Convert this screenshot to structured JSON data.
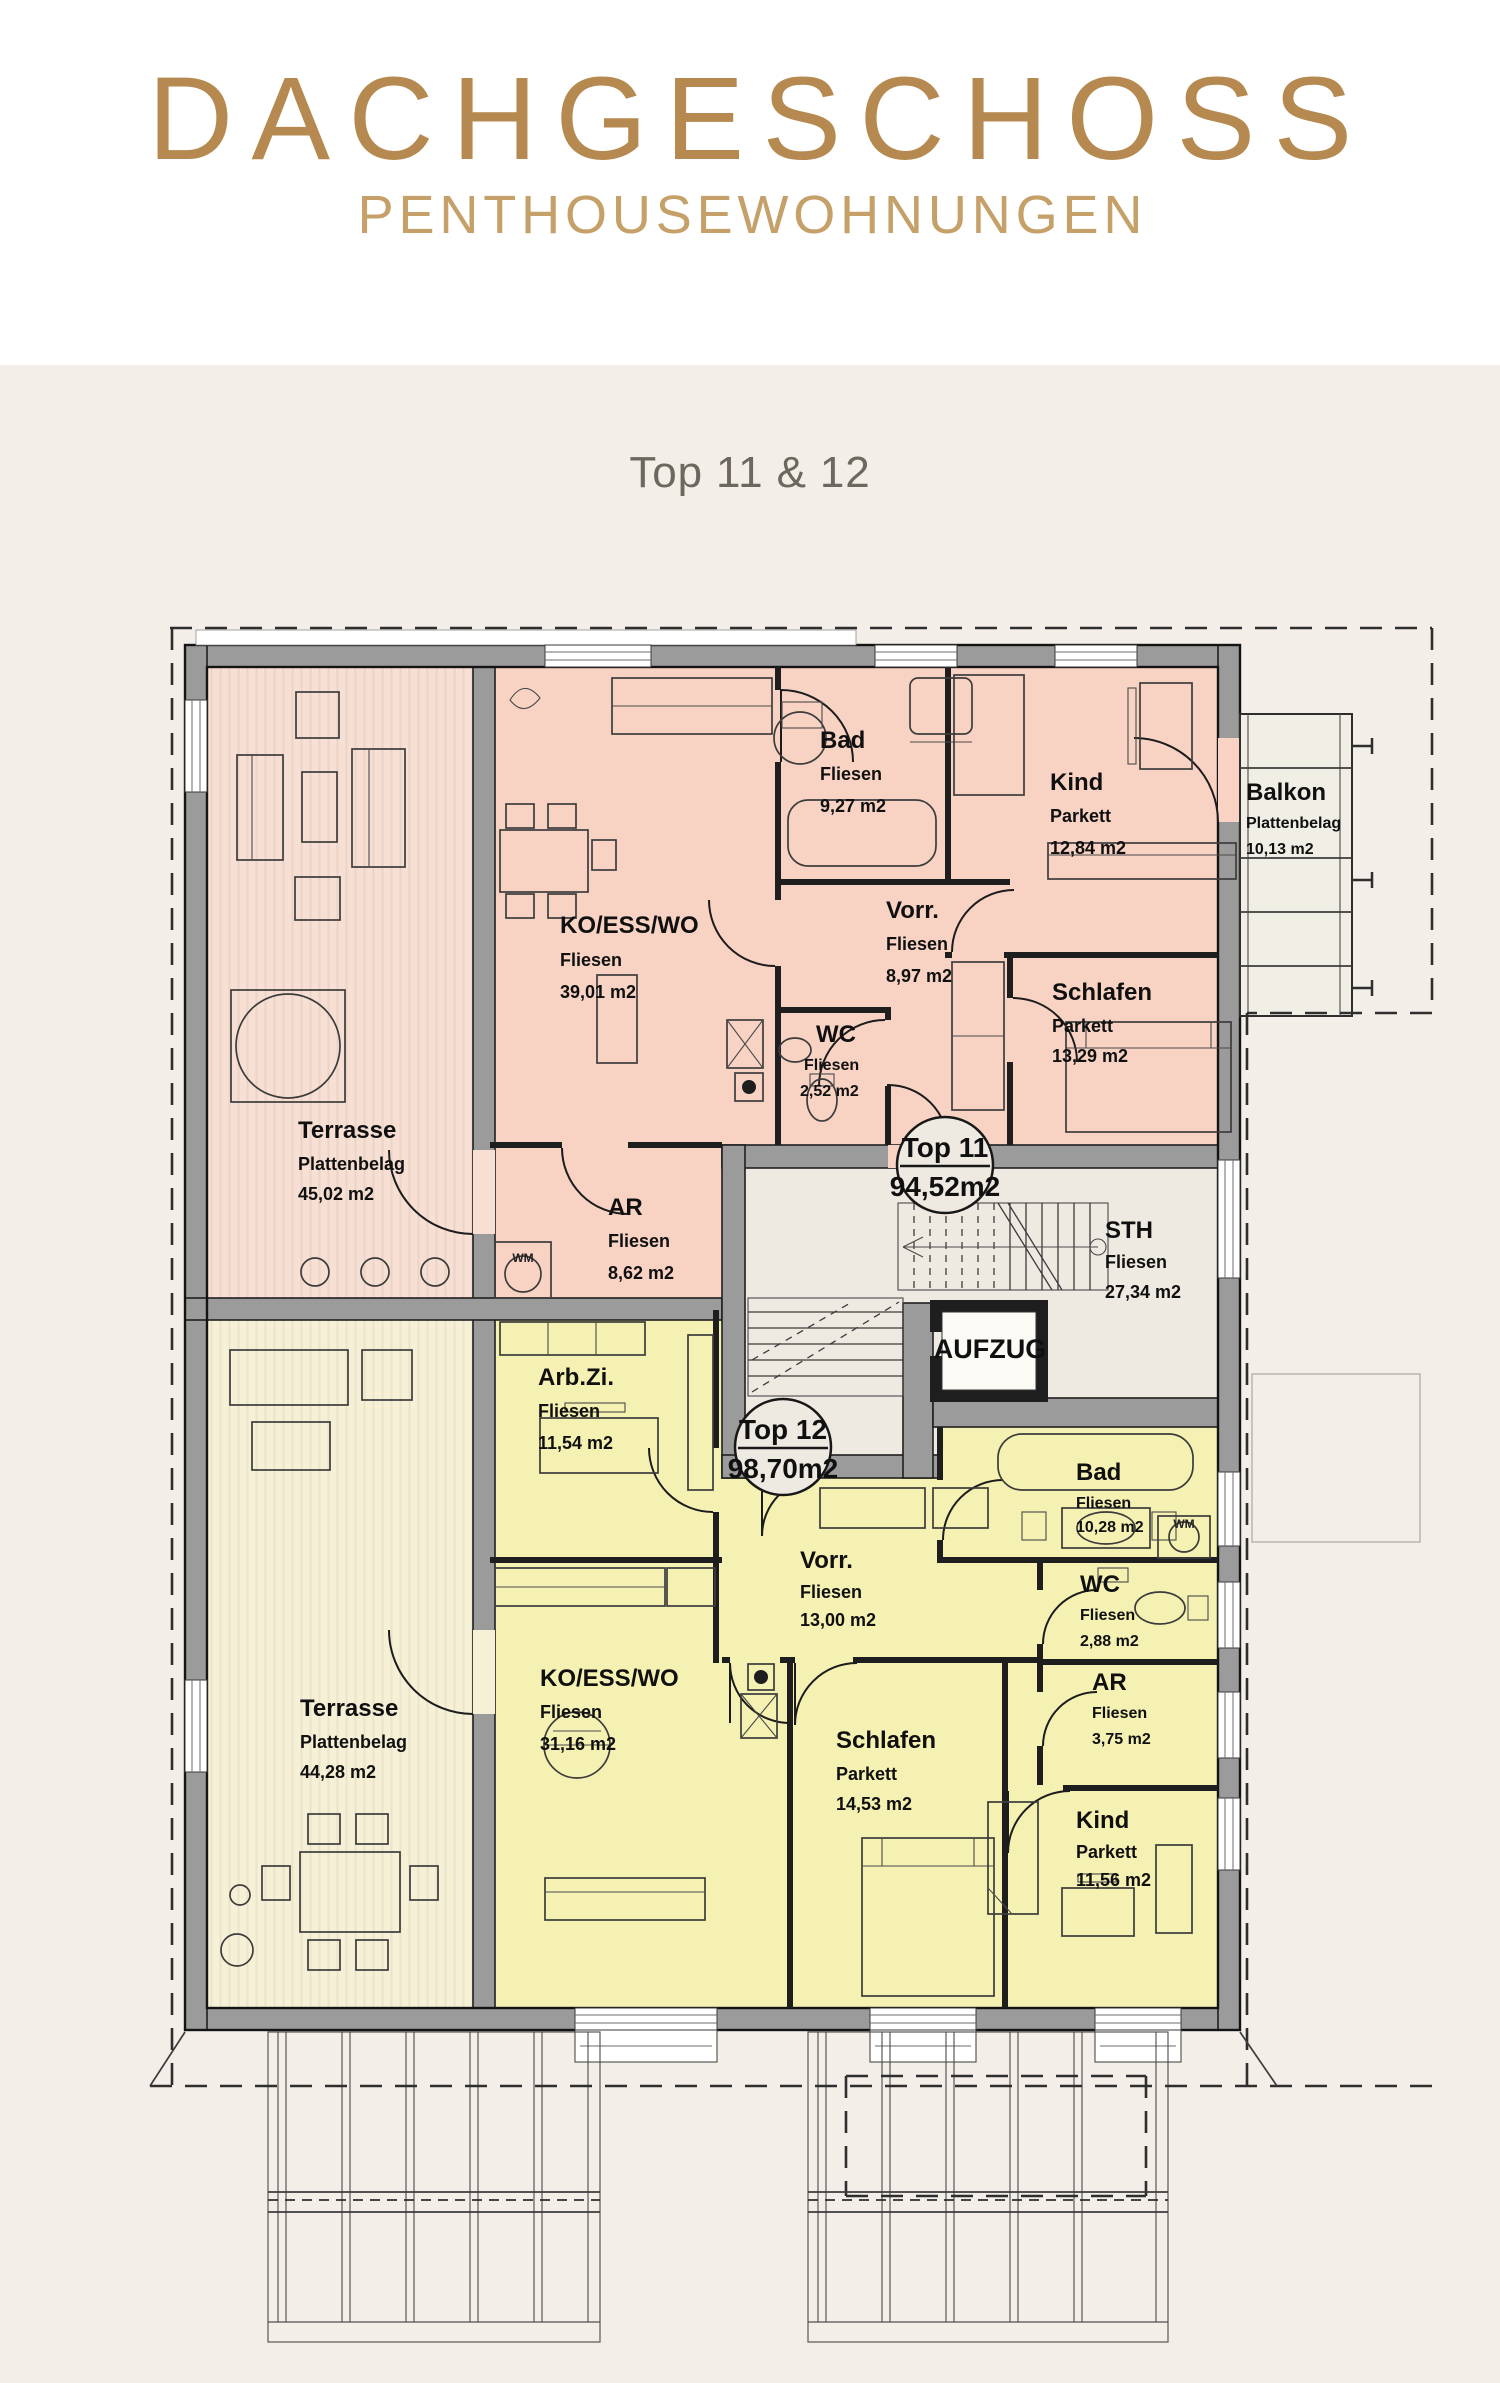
{
  "header": {
    "title": "DACHGESCHOSS",
    "subtitle": "PENTHOUSEWOHNUNGEN",
    "plan_label": "Top 11 & 12"
  },
  "colors": {
    "title": "#b5894f",
    "subtitle": "#c5a069",
    "header_bg": "#ffffff",
    "page_bg": "#f3efe8",
    "pink_room": "#f8d3c3",
    "pink_terrace": "#f7dfd3",
    "yellow_room": "#f5f1b2",
    "yellow_terrace": "#f6f0d6",
    "common_bg": "#eeeae1",
    "wall_gray": "#9b9b9b"
  },
  "units": {
    "top11": {
      "label": "Top 11",
      "area": "94,52m2"
    },
    "top12": {
      "label": "Top 12",
      "area": "98,70m2"
    }
  },
  "rooms": {
    "t11_terrasse": {
      "name": "Terrasse",
      "floor": "Plattenbelag",
      "area": "45,02 m2"
    },
    "t11_ko": {
      "name": "KO/ESS/WO",
      "floor": "Fliesen",
      "area": "39,01 m2"
    },
    "t11_bad": {
      "name": "Bad",
      "floor": "Fliesen",
      "area": "9,27 m2"
    },
    "t11_kind": {
      "name": "Kind",
      "floor": "Parkett",
      "area": "12,84 m2"
    },
    "t11_vorr": {
      "name": "Vorr.",
      "floor": "Fliesen",
      "area": "8,97 m2"
    },
    "t11_schlafen": {
      "name": "Schlafen",
      "floor": "Parkett",
      "area": "13,29 m2"
    },
    "t11_wc": {
      "name": "WC",
      "floor": "Fliesen",
      "area": "2,52 m2"
    },
    "t11_ar": {
      "name": "AR",
      "floor": "Fliesen",
      "area": "8,62 m2"
    },
    "balkon": {
      "name": "Balkon",
      "floor": "Plattenbelag",
      "area": "10,13 m2"
    },
    "sth": {
      "name": "STH",
      "floor": "Fliesen",
      "area": "27,34 m2"
    },
    "aufzug": {
      "name": "AUFZUG"
    },
    "t12_arbzi": {
      "name": "Arb.Zi.",
      "floor": "Fliesen",
      "area": "11,54 m2"
    },
    "t12_terrasse": {
      "name": "Terrasse",
      "floor": "Plattenbelag",
      "area": "44,28 m2"
    },
    "t12_ko": {
      "name": "KO/ESS/WO",
      "floor": "Fliesen",
      "area": "31,16 m2"
    },
    "t12_vorr": {
      "name": "Vorr.",
      "floor": "Fliesen",
      "area": "13,00 m2"
    },
    "t12_schlafen": {
      "name": "Schlafen",
      "floor": "Parkett",
      "area": "14,53 m2"
    },
    "t12_bad": {
      "name": "Bad",
      "floor": "Fliesen",
      "area": "10,28 m2"
    },
    "t12_wc": {
      "name": "WC",
      "floor": "Fliesen",
      "area": "2,88 m2"
    },
    "t12_ar": {
      "name": "AR",
      "floor": "Fliesen",
      "area": "3,75 m2"
    },
    "t12_kind": {
      "name": "Kind",
      "floor": "Parkett",
      "area": "11,56 m2"
    }
  },
  "icons": {
    "wm": "WM"
  }
}
